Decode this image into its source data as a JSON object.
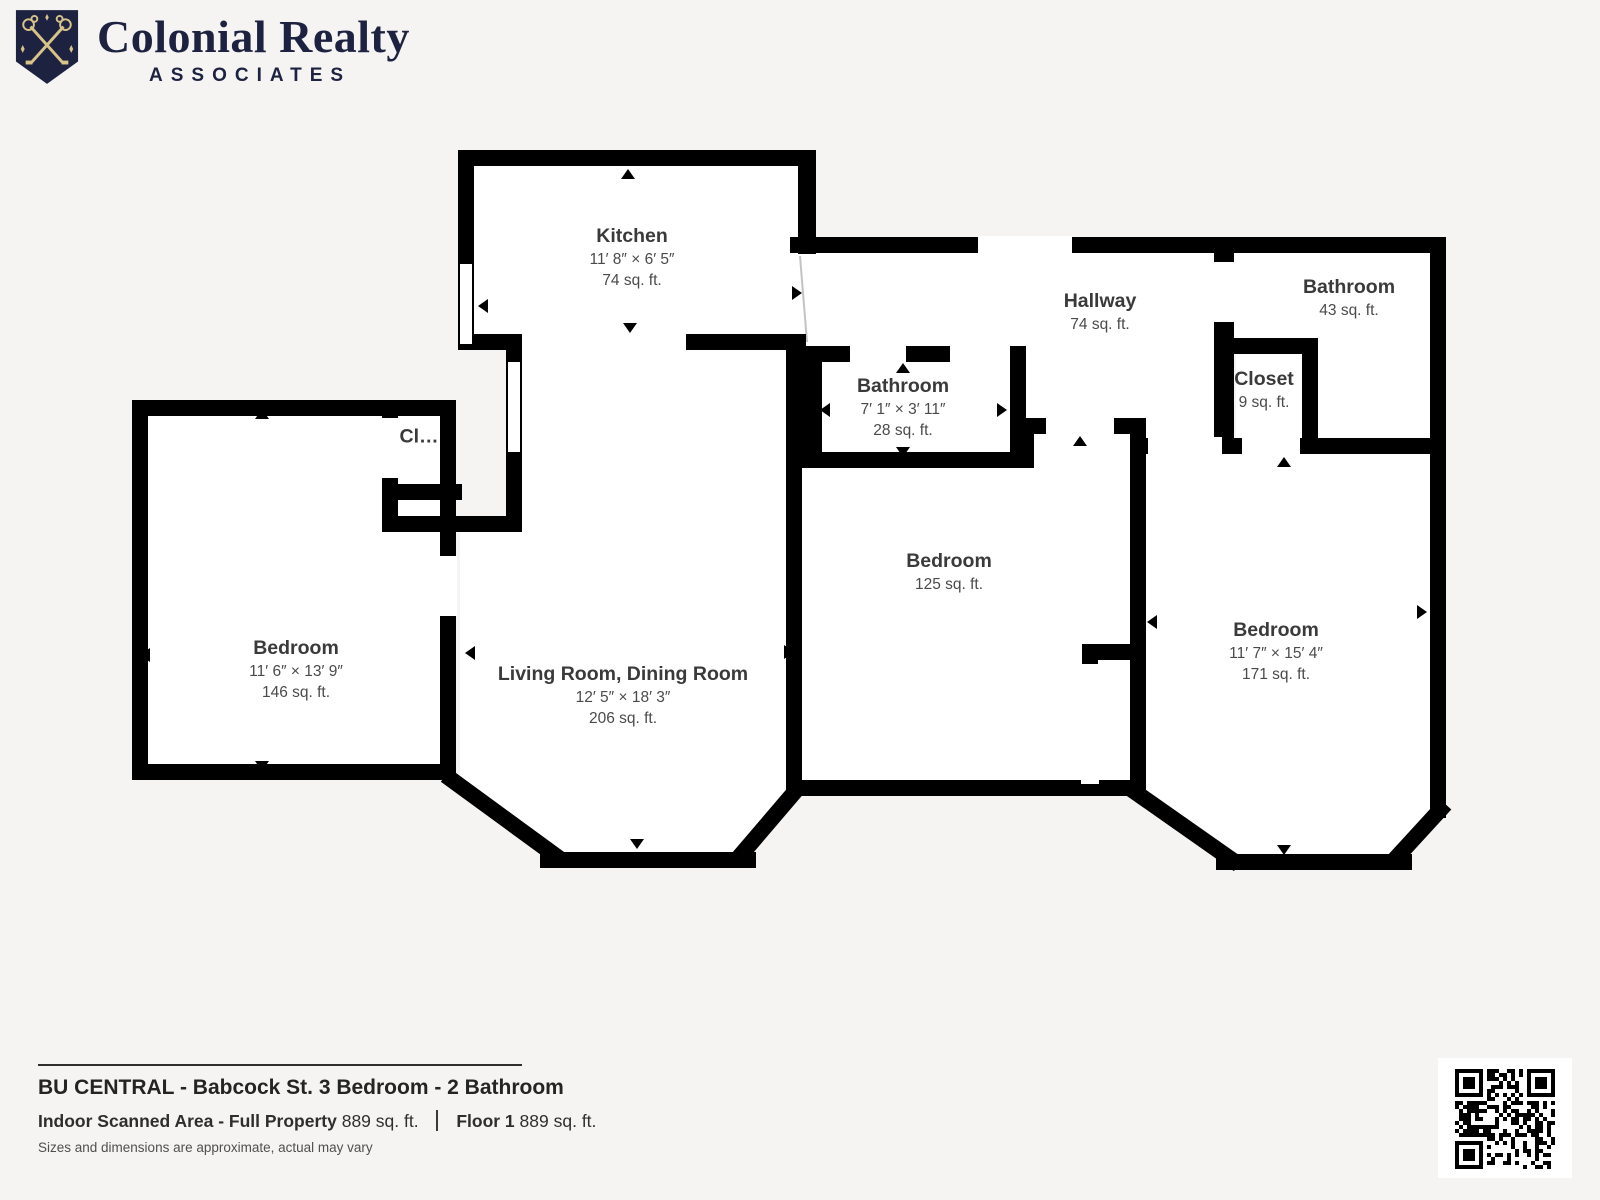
{
  "brand": {
    "name": "Colonial Realty",
    "subname": "ASSOCIATES"
  },
  "colors": {
    "brand_navy": "#1d2240",
    "brand_gold": "#d8c389",
    "wall_black": "#000000",
    "floor_white": "#ffffff",
    "page_background": "#f5f4f2",
    "label_gray": "#3a3a3a"
  },
  "rooms": {
    "kitchen": {
      "name": "Kitchen",
      "dims": "11′ 8″ × 6′ 5″",
      "area": "74 sq. ft."
    },
    "hallway": {
      "name": "Hallway",
      "area": "74 sq. ft."
    },
    "bathroom_top_right": {
      "name": "Bathroom",
      "area": "43 sq. ft."
    },
    "closet_right": {
      "name": "Closet",
      "area": "9 sq. ft."
    },
    "bathroom_middle": {
      "name": "Bathroom",
      "dims": "7′ 1″ × 3′ 11″",
      "area": "28 sq. ft."
    },
    "closet_left": {
      "name": "Cl…"
    },
    "bedroom_left": {
      "name": "Bedroom",
      "dims": "11′ 6″ × 13′ 9″",
      "area": "146 sq. ft."
    },
    "living_dining": {
      "name": "Living Room, Dining Room",
      "dims": "12′ 5″ × 18′ 3″",
      "area": "206 sq. ft."
    },
    "bedroom_middle": {
      "name": "Bedroom",
      "area": "125 sq. ft."
    },
    "bedroom_right": {
      "name": "Bedroom",
      "dims": "11′ 7″ × 15′ 4″",
      "area": "171 sq. ft."
    }
  },
  "footer": {
    "title": "BU CENTRAL - Babcock St. 3 Bedroom - 2 Bathroom",
    "scanned_area_label": "Indoor Scanned Area - Full Property",
    "scanned_area_value": "889 sq. ft.",
    "floor_label": "Floor 1",
    "floor_value": "889 sq. ft.",
    "disclaimer": "Sizes and dimensions are approximate, actual may vary"
  }
}
